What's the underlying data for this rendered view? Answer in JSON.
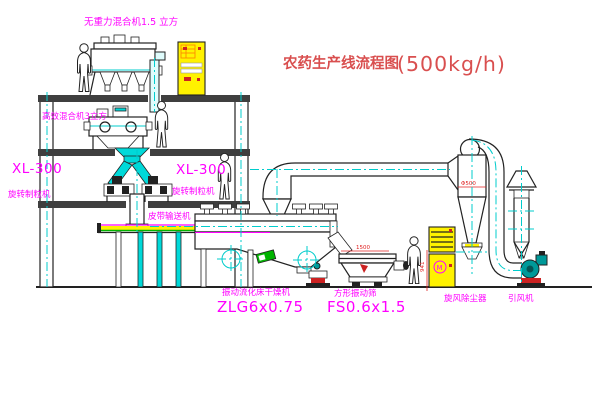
{
  "title": {
    "name": "农药生产线流程图",
    "capacity": "(500kg/h)"
  },
  "labels": {
    "gravity_mixer": "无重力混合机1.5 立方",
    "mixer_3m3": "高效混合机3立方",
    "granulator_left_model": "XL-300",
    "granulator_left_name": "旋转制粒机",
    "granulator_right_model": "XL-300",
    "granulator_right_name": "旋转制粒机",
    "belt_conveyor": "皮带输送机",
    "dryer_name": "振动流化床干燥机",
    "dryer_model": "ZLG6x0.75",
    "sieve_name": "方形振动筛",
    "sieve_model": "FS0.6x1.5",
    "cyclone_name": "旋风除尘器",
    "fan_name": "引风机"
  },
  "dimensions": {
    "sieve_width": "1500",
    "sieve_height": "941",
    "cyclone_diameter": "Φ500"
  },
  "colors": {
    "line": "#222222",
    "pipe_cyan": "#00cccc",
    "label_magenta": "#ff00ff",
    "title_red": "#d94f4f",
    "cabinet_yellow": "#fff200",
    "green": "#00b400",
    "fan_teal": "#009999"
  }
}
